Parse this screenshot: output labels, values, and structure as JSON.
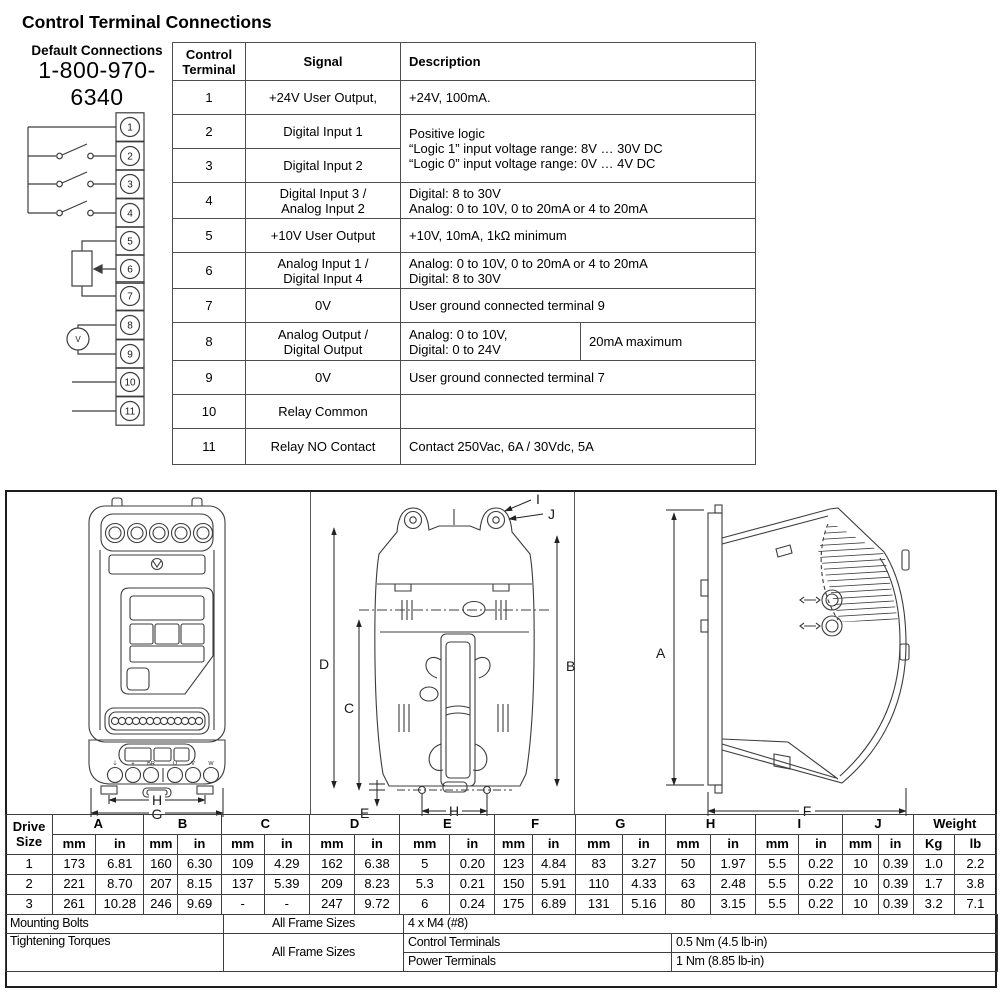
{
  "page_title": "Control Terminal Connections",
  "default_connections": {
    "label": "Default Connections",
    "phone": "1-800-970-6340",
    "terminal_numbers": [
      "1",
      "2",
      "3",
      "4",
      "5",
      "6",
      "7",
      "8",
      "9",
      "10",
      "11"
    ],
    "voltmeter_label": "V"
  },
  "terminal_table": {
    "header": {
      "col1": "Control\nTerminal",
      "col2": "Signal",
      "col3": "Description"
    },
    "rows": {
      "r1": {
        "terminal": "1",
        "signal": "+24V User Output,",
        "description": "+24V, 100mA."
      },
      "r2": {
        "terminal": "2",
        "signal": "Digital Input 1",
        "description": "Positive logic\n“Logic 1” input voltage range: 8V … 30V DC\n“Logic 0” input voltage range: 0V … 4V DC"
      },
      "r3": {
        "terminal": "3",
        "signal": "Digital Input 2"
      },
      "r4": {
        "terminal": "4",
        "signal": "Digital Input 3 /\nAnalog Input 2",
        "description": "Digital: 8 to 30V\nAnalog: 0 to 10V, 0 to 20mA or 4 to 20mA"
      },
      "r5": {
        "terminal": "5",
        "signal": "+10V User Output",
        "description": "+10V, 10mA, 1kΩ minimum"
      },
      "r6": {
        "terminal": "6",
        "signal": "Analog Input 1 /\nDigital Input 4",
        "description": "Analog: 0 to 10V, 0 to 20mA or 4 to 20mA\nDigital:  8 to 30V"
      },
      "r7": {
        "terminal": "7",
        "signal": "0V",
        "description": "User ground connected terminal 9"
      },
      "r8": {
        "terminal": "8",
        "signal": "Analog Output /\nDigital Output",
        "description": "Analog: 0 to 10V,\nDigital:  0 to 24V",
        "description_extra": "20mA maximum"
      },
      "r9": {
        "terminal": "9",
        "signal": "0V",
        "description": "User ground connected terminal 7"
      },
      "r10": {
        "terminal": "10",
        "signal": "Relay Common",
        "description": ""
      },
      "r11": {
        "terminal": "11",
        "signal": "Relay NO Contact",
        "description": "Contact 250Vac, 6A / 30Vdc, 5A"
      }
    }
  },
  "dimension_drawings": {
    "front_view_labels": {
      "h": "H",
      "g": "G"
    },
    "front_view_terminal_labels": [
      "⏚",
      "+",
      "BR",
      "U",
      "V",
      "W"
    ],
    "back_view_labels": {
      "d": "D",
      "c": "C",
      "b": "B",
      "e": "E",
      "h": "H",
      "i": "I",
      "j": "J"
    },
    "side_view_labels": {
      "a": "A",
      "f": "F"
    }
  },
  "dimension_table": {
    "row_header": "Drive\nSize",
    "columns": [
      "A",
      "B",
      "C",
      "D",
      "E",
      "F",
      "G",
      "H",
      "I",
      "J"
    ],
    "unit_mm": "mm",
    "unit_in": "in",
    "weight_label": "Weight",
    "weight_units": [
      "Kg",
      "lb"
    ],
    "rows": [
      {
        "size": "1",
        "values": [
          [
            "173",
            "6.81"
          ],
          [
            "160",
            "6.30"
          ],
          [
            "109",
            "4.29"
          ],
          [
            "162",
            "6.38"
          ],
          [
            "5",
            "0.20"
          ],
          [
            "123",
            "4.84"
          ],
          [
            "83",
            "3.27"
          ],
          [
            "50",
            "1.97"
          ],
          [
            "5.5",
            "0.22"
          ],
          [
            "10",
            "0.39"
          ]
        ],
        "weight": [
          "1.0",
          "2.2"
        ]
      },
      {
        "size": "2",
        "values": [
          [
            "221",
            "8.70"
          ],
          [
            "207",
            "8.15"
          ],
          [
            "137",
            "5.39"
          ],
          [
            "209",
            "8.23"
          ],
          [
            "5.3",
            "0.21"
          ],
          [
            "150",
            "5.91"
          ],
          [
            "110",
            "4.33"
          ],
          [
            "63",
            "2.48"
          ],
          [
            "5.5",
            "0.22"
          ],
          [
            "10",
            "0.39"
          ]
        ],
        "weight": [
          "1.7",
          "3.8"
        ]
      },
      {
        "size": "3",
        "values": [
          [
            "261",
            "10.28"
          ],
          [
            "246",
            "9.69"
          ],
          [
            "-",
            "-"
          ],
          [
            "247",
            "9.72"
          ],
          [
            "6",
            "0.24"
          ],
          [
            "175",
            "6.89"
          ],
          [
            "131",
            "5.16"
          ],
          [
            "80",
            "3.15"
          ],
          [
            "5.5",
            "0.22"
          ],
          [
            "10",
            "0.39"
          ]
        ],
        "weight": [
          "3.2",
          "7.1"
        ]
      }
    ]
  },
  "mounting_info": {
    "mounting_bolts_label": "Mounting Bolts",
    "mounting_bolts_scope": "All Frame Sizes",
    "mounting_bolts_value": "4 x M4 (#8)",
    "tightening_torques_label": "Tightening Torques",
    "tightening_torques_scope": "All Frame Sizes",
    "control_terminals_label": "Control Terminals",
    "control_terminals_value": "0.5 Nm (4.5 lb-in)",
    "power_terminals_label": "Power Terminals",
    "power_terminals_value": "1 Nm (8.85 lb-in)"
  },
  "colors": {
    "line": "#3c3c3c",
    "border": "#4d4d4d",
    "text": "#000000"
  }
}
